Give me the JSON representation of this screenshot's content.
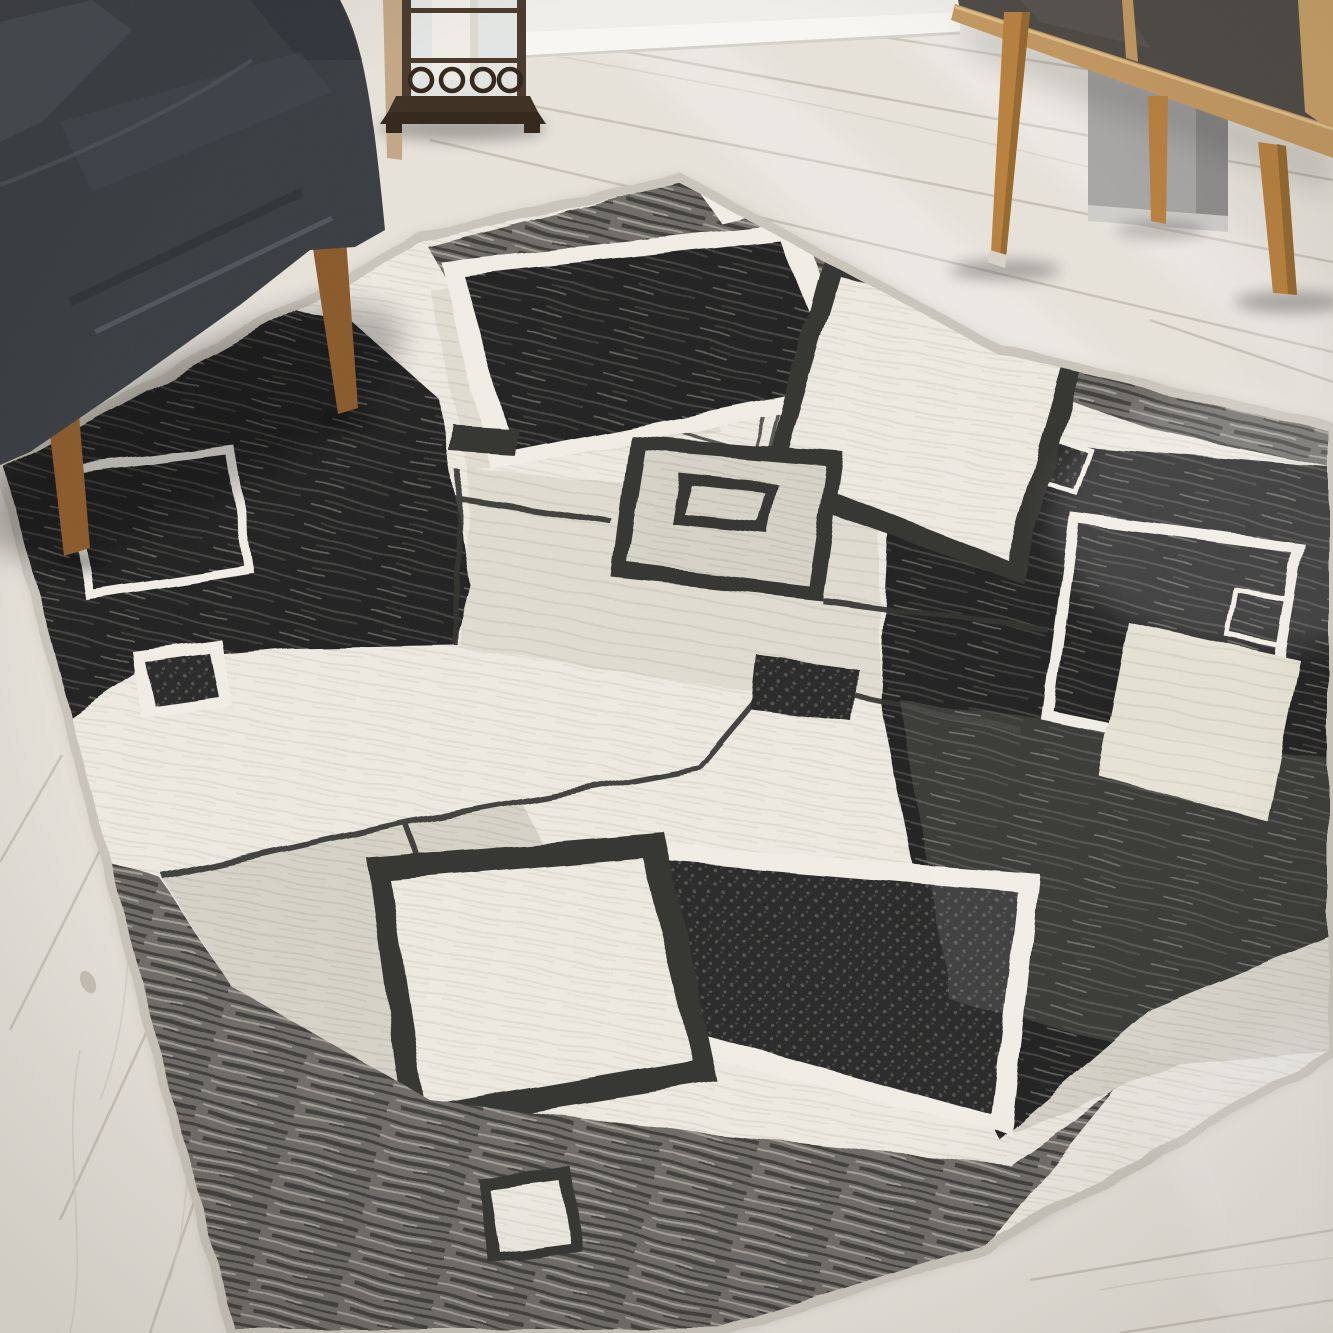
{
  "scene": {
    "title": "Modern geometric area rug in gray, black and ivory laid on a whitewashed wood floor, with a dark gray fabric armchair, a bronze candle lantern and a mid-century oak sideboard",
    "objects": {
      "floor": {
        "label": "whitewashed light oak plank floor",
        "finish": "matte, sun streaks from a window"
      },
      "wall_back": {
        "label": "white wall with baseboard",
        "position": "top center"
      },
      "wall_corner": {
        "label": "gray wall corner",
        "position": "top right behind sideboard"
      },
      "armchair": {
        "label": "charcoal fabric armchair",
        "material": "linen weave",
        "legs": "tapered walnut wood",
        "position": "top left, front legs standing on the rug"
      },
      "lantern": {
        "label": "bronze candle lantern",
        "details": "glass panels, white pillar candle, ring ornament band, stepped base with feet",
        "position": "top center on floor against wall"
      },
      "sideboard": {
        "label": "mid-century oak sideboard with dark slate door panels",
        "legs": "splayed tapered oak",
        "position": "top right"
      },
      "rug": {
        "label": "contemporary rug with overlapping squares pattern",
        "colors": [
          "ivory",
          "light gray",
          "greige",
          "charcoal black",
          "cream"
        ],
        "edge": "light gray serged binding",
        "pattern_elements": [
          "mottled gray striped band along top edge with small white square",
          "white-outlined dark rectangle at right end of top band",
          "large black square with white rim, top center",
          "white square with black rim and double pinstripe outlines, top right of center",
          "large mottled black field on left with white outlined square under chair legs",
          "small black square with white rim on left seam",
          "center light square with black rim and nested outlined square",
          "small dark connector rectangles on seam lines",
          "large mottled black field on right containing white outlined square, small outlined square and cream square",
          "bottom center white square with thick black rim",
          "bottom black pebbled square with white rim",
          "mottled gray striped band along bottom edge with small white square",
          "thin dark seam lines dividing ivory, pale gray and greige panels"
        ]
      }
    }
  },
  "palette": {
    "floor": "#e7e3db",
    "floorSeam": "#c2bcb0",
    "grainLight": "#d6d0c4",
    "knot": "#b3aa9b",
    "wallWhite": "#f0efeb",
    "baseboardLight": "#f8f7f3",
    "baseboardShadow": "#c7c3bc",
    "wallGray": "#a8a7a5",
    "wallGrayDark": "#8f8e8c",
    "wallBaseLight": "#d0cecb",
    "chairFabric": "#3a3d42",
    "chairFabricDark": "#313439",
    "chairFabricLight": "#474b51",
    "chairSeam": "#575b62",
    "chairCrease": "#2b2e32",
    "chairLeg": "#8a5a2b",
    "chairLegLight": "#a9житель7036",
    "bronze": "#4a392b",
    "bronzeDark": "#33271b",
    "bronzeMid": "#3e3022",
    "glass": "#e2e5e3",
    "candle": "#efede6",
    "woodPost": "#c3a886",
    "oak": "#c59a62",
    "oakLight": "#e0c08a",
    "oakSide": "#caa268",
    "slate": "#4e4a46",
    "slateLight": "#5d5954",
    "sbLeg": "#b9813f",
    "sbLegShade": "#96692f",
    "footCap": "#d9d3c8",
    "rugBaseIvory": "#edeae2",
    "rugIvoryStrong": "#f1eee6",
    "rugGreige": "#dedacf",
    "rugPale": "#d6d3c9",
    "rugCream": "#e5e1d3",
    "rugDark": "#343431",
    "rugBlack": "#242423",
    "blackStripeLight": "#454341",
    "speckBase": "#2c2b2a",
    "speckDot": "#54524e",
    "bandBase": "#6f6d67",
    "bandDark": "#413f3d",
    "bandLight": "#a29e96",
    "weaveIvoryLine": "#dfdbd1",
    "weavePaleLine": "#c7c3b8",
    "weaveGreigeLine": "#cfcabf",
    "weaveCreamLine": "#d7d2c3",
    "binding": "#cbc6bc"
  }
}
